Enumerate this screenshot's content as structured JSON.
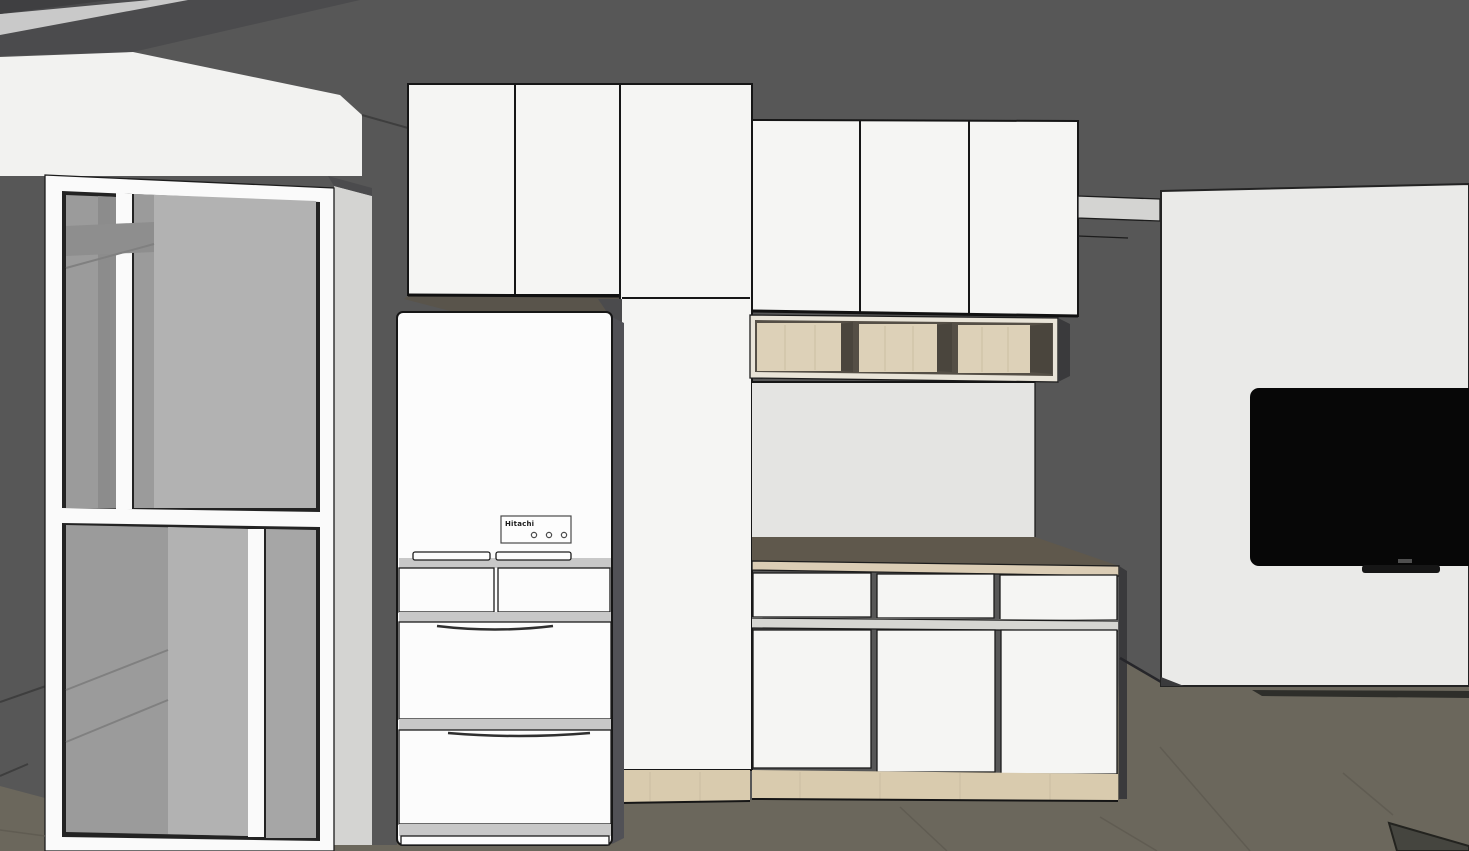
{
  "scene": {
    "render_style": "3d interior render",
    "room": "kitchen",
    "fridge_brand": "Hitachi"
  },
  "counts": {
    "fridge_indicator_lights": 3,
    "upper_cabinet_doors_left": 2,
    "upper_cabinet_doors_right": 3,
    "open_shelf_bays": 3,
    "counter_drawers": 3,
    "base_cabinet_doors": 3
  },
  "colors": {
    "wall": "#575757",
    "wall_dark": "#4b4b4d",
    "wall_darkest": "#3f3f41",
    "ceiling_strip": "#c9c9c9",
    "soffit": "#f2f2f0",
    "wall_strip_light": "#d4d4d2",
    "floor": "#6b675c",
    "floor_shadow": "#45453f",
    "frame_white": "#fafafa",
    "glass": "#9b9b9b",
    "glass_dark": "#8c8c8c",
    "glass_light": "#b2b2b2",
    "glass_mid": "#a6a6a6",
    "glass_band": "#8e8e8e",
    "cabinet": "#f5f5f3",
    "cabinet_underside": "#59544b",
    "fridge": "#fcfcfc",
    "fridge_strip": "#c8c8c8",
    "fridge_side": "#515156",
    "panel_white": "#fdfdfd",
    "wood": "#d9cbae",
    "shelf_frame": "#e9e4d8",
    "shelf_dark": "#554f46",
    "shelf_back": "#ddd1b8",
    "shelf_side": "#4a453d",
    "counter_top": "#5f584c",
    "counter_edge": "#dbcdb5",
    "backsplash": "#e4e4e2",
    "reveal": "#d6d6d2",
    "ledge": "#d4d4d2",
    "side_dark": "#3a3a3c",
    "shadow_dark": "#2e2e2a",
    "tv_wall": "#eaeae8",
    "tv_black": "#070707",
    "tv_stand": "#161616",
    "tv_brand": "#4f4f4f"
  }
}
